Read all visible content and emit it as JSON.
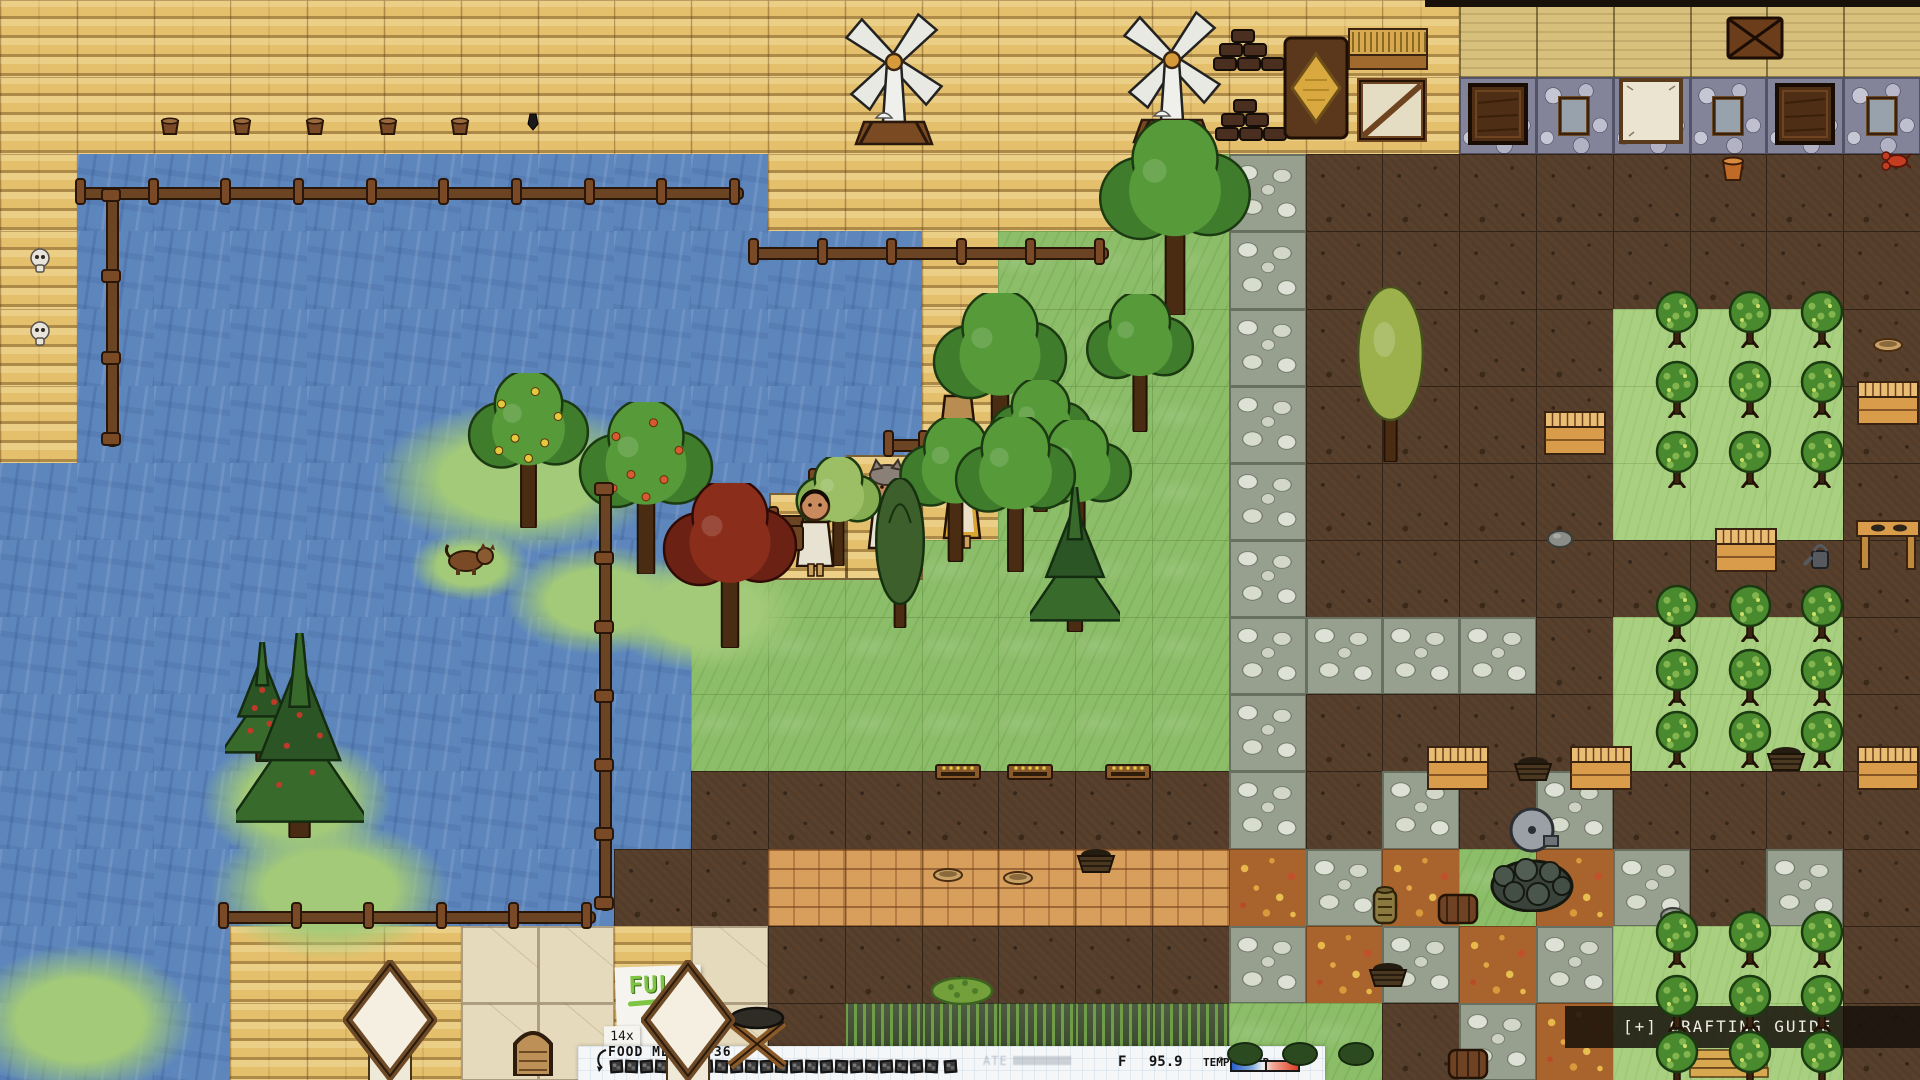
{
  "hud": {
    "crafting_guide": {
      "label": "[+] CRAFTING GUIDE"
    },
    "food_meter": {
      "label": "FOOD METER",
      "bonus": "+36",
      "multiplier": "14x",
      "boxes_total": 22,
      "boxes_filled": 22,
      "extra_boxes": 1,
      "ate_note": "ATE"
    },
    "full_sign": {
      "label": "FULL",
      "icon": "cookie-icon"
    },
    "temp_meter": {
      "unit": "F",
      "value": "95.9",
      "label": "TEMP METER",
      "indicator_pos": 0.44
    }
  },
  "colors": {
    "water": "#5d86bd",
    "plank": "#e5c06c",
    "grass": "#8cbd68",
    "grass_light": "#a9d080",
    "dirt": "#58402d",
    "cobble": "#97a08e",
    "brick": "#d79e5c",
    "leaf": "#a8642c",
    "full_green": "#7ec544",
    "temp_cold": "#2b5fc9",
    "temp_hot": "#dd3d22",
    "craft_bar": "rgba(22,16,10,0.85)",
    "hud_paper": "#f4f6f8"
  },
  "scene": {
    "tile_w": 76.8,
    "tile_h": 77.142,
    "tiles": [
      "PPPPPPPPPPPPPPPPPPPTTTTTT",
      "PPPPPPPPPPPPPPPPPPPSSSSSS",
      "PWWWWWWWWWPPPPPGCDDDDDDDD",
      "PWWWWWWWWWWWPGGGCDDDDDDDD",
      "PWWWWWWWWWWWPGGGCDDDDHHHD",
      "PWWWWWWWWWWWPGGGCDDDDHHHD",
      "WWWWWWWWWWWWPGGGCDDDDHHHD",
      "WWWWWWWWWGGGGGGGCDDDDDDDD",
      "WWWWWWWWWGGGGGGGCCCCDHHHD",
      "WWWWWWWWWGGGGGGGCDDDDHHHD",
      "WWWWWWWWWDDDDDDDCDCDCDDDD",
      "WWWWWWWWDDBBBBBBLCLGLCDCD",
      "WWWPPPAAPADDDDDDCLCLCHHHD",
      "WWWPPPAAPADRRRRRGGDCLHHHD"
    ],
    "objects": [
      {
        "t": "blob",
        "x": 520,
        "y": 478,
        "w": 290,
        "h": 150
      },
      {
        "t": "blob",
        "x": 600,
        "y": 600,
        "w": 190,
        "h": 110
      },
      {
        "t": "blob",
        "x": 705,
        "y": 612,
        "w": 200,
        "h": 120
      },
      {
        "t": "blob",
        "x": 330,
        "y": 890,
        "w": 240,
        "h": 140
      },
      {
        "t": "blob",
        "x": 80,
        "y": 1020,
        "w": 230,
        "h": 150
      },
      {
        "t": "blob",
        "x": 297,
        "y": 800,
        "w": 190,
        "h": 130
      },
      {
        "t": "blob",
        "x": 470,
        "y": 566,
        "w": 120,
        "h": 70
      },
      {
        "t": "step",
        "x": 846,
        "y": 455,
        "w": 77,
        "h": 125
      },
      {
        "t": "step",
        "x": 769,
        "y": 493,
        "w": 78,
        "h": 87
      },
      {
        "t": "fenceH",
        "x": 75,
        "y": 178,
        "len": 665
      },
      {
        "t": "fenceH",
        "x": 748,
        "y": 238,
        "len": 357
      },
      {
        "t": "fenceH",
        "x": 218,
        "y": 902,
        "len": 374
      },
      {
        "t": "fenceV",
        "x": 97,
        "y": 188,
        "len": 255
      },
      {
        "t": "fenceV",
        "x": 590,
        "y": 482,
        "len": 425
      },
      {
        "t": "fenceH",
        "x": 733,
        "y": 506,
        "len": 80
      },
      {
        "t": "fenceH",
        "x": 808,
        "y": 468,
        "len": 80
      },
      {
        "t": "fenceH",
        "x": 883,
        "y": 430,
        "len": 80
      },
      {
        "t": "windmill",
        "x": 894,
        "y": 150
      },
      {
        "t": "windmill",
        "x": 1172,
        "y": 148
      },
      {
        "t": "bricks",
        "x": 1249,
        "y": 72
      },
      {
        "t": "bricks",
        "x": 1251,
        "y": 142
      },
      {
        "t": "kiln",
        "x": 1316,
        "y": 142
      },
      {
        "t": "wheatTable",
        "x": 1388,
        "y": 70
      },
      {
        "t": "crate2",
        "x": 1392,
        "y": 142
      },
      {
        "t": "chest",
        "x": 1755,
        "y": 60
      },
      {
        "t": "wallDoor",
        "x": 1498,
        "y": 145
      },
      {
        "t": "wallWindow",
        "x": 1574,
        "y": 136
      },
      {
        "t": "wallPaper",
        "x": 1651,
        "y": 144
      },
      {
        "t": "wallWindow",
        "x": 1728,
        "y": 136
      },
      {
        "t": "wallDoor",
        "x": 1805,
        "y": 145
      },
      {
        "t": "wallWindow",
        "x": 1882,
        "y": 136
      },
      {
        "t": "bucket",
        "x": 170,
        "y": 136
      },
      {
        "t": "bucket",
        "x": 242,
        "y": 136
      },
      {
        "t": "bucket",
        "x": 315,
        "y": 136
      },
      {
        "t": "bucket",
        "x": 388,
        "y": 136
      },
      {
        "t": "bucket",
        "x": 460,
        "y": 136
      },
      {
        "t": "chisel",
        "x": 533,
        "y": 132
      },
      {
        "t": "skull",
        "x": 40,
        "y": 274
      },
      {
        "t": "skull",
        "x": 40,
        "y": 347
      },
      {
        "t": "lobster",
        "x": 1896,
        "y": 172
      },
      {
        "t": "pot",
        "x": 1733,
        "y": 182
      },
      {
        "t": "tree",
        "x": 1175,
        "y": 315,
        "s": 170
      },
      {
        "t": "tree",
        "x": 1140,
        "y": 432,
        "s": 120
      },
      {
        "t": "tree",
        "x": 1000,
        "y": 465,
        "s": 150
      },
      {
        "t": "tree",
        "x": 1040,
        "y": 512,
        "s": 115
      },
      {
        "t": "tree",
        "x": 955,
        "y": 562,
        "s": 125
      },
      {
        "t": "tree",
        "x": 1015,
        "y": 572,
        "s": 135
      },
      {
        "t": "tree",
        "x": 1078,
        "y": 558,
        "s": 120
      },
      {
        "t": "pine",
        "x": 1075,
        "y": 632,
        "s": 145
      },
      {
        "t": "cypress",
        "x": 900,
        "y": 628,
        "s": 150
      },
      {
        "t": "maroon",
        "x": 730,
        "y": 648,
        "s": 150
      },
      {
        "t": "tree",
        "x": 838,
        "y": 566,
        "s": 95,
        "v": "light"
      },
      {
        "t": "poplar",
        "x": 1390,
        "y": 462,
        "s": 175
      },
      {
        "t": "fruit",
        "x": 528,
        "y": 528,
        "s": 135,
        "dots": "#e6c83e"
      },
      {
        "t": "fruit",
        "x": 646,
        "y": 574,
        "s": 150,
        "dots": "#d85a32"
      },
      {
        "t": "pine",
        "x": 262,
        "y": 762,
        "s": 120,
        "dots": "#c03a2a"
      },
      {
        "t": "pine",
        "x": 300,
        "y": 838,
        "s": 205,
        "dots": "#c03a2a"
      },
      {
        "t": "bush",
        "x": 1677,
        "y": 348
      },
      {
        "t": "bush",
        "x": 1750,
        "y": 348
      },
      {
        "t": "bush",
        "x": 1822,
        "y": 348
      },
      {
        "t": "bush",
        "x": 1677,
        "y": 418
      },
      {
        "t": "bush",
        "x": 1750,
        "y": 418
      },
      {
        "t": "bush",
        "x": 1822,
        "y": 418
      },
      {
        "t": "bush",
        "x": 1677,
        "y": 488
      },
      {
        "t": "bush",
        "x": 1750,
        "y": 488
      },
      {
        "t": "bush",
        "x": 1822,
        "y": 488
      },
      {
        "t": "bush",
        "x": 1677,
        "y": 642
      },
      {
        "t": "bush",
        "x": 1750,
        "y": 642
      },
      {
        "t": "bush",
        "x": 1822,
        "y": 642
      },
      {
        "t": "bush",
        "x": 1677,
        "y": 706
      },
      {
        "t": "bush",
        "x": 1750,
        "y": 706
      },
      {
        "t": "bush",
        "x": 1822,
        "y": 706
      },
      {
        "t": "bush",
        "x": 1677,
        "y": 768
      },
      {
        "t": "bush",
        "x": 1750,
        "y": 768
      },
      {
        "t": "bush",
        "x": 1822,
        "y": 768
      },
      {
        "t": "bush",
        "x": 1677,
        "y": 968
      },
      {
        "t": "bush",
        "x": 1750,
        "y": 968
      },
      {
        "t": "bush",
        "x": 1822,
        "y": 968
      },
      {
        "t": "bush",
        "x": 1677,
        "y": 1032
      },
      {
        "t": "bush",
        "x": 1750,
        "y": 1032
      },
      {
        "t": "bush",
        "x": 1822,
        "y": 1032
      },
      {
        "t": "bush",
        "x": 1677,
        "y": 1088
      },
      {
        "t": "bush",
        "x": 1750,
        "y": 1088
      },
      {
        "t": "bush",
        "x": 1822,
        "y": 1088
      },
      {
        "t": "shrub",
        "x": 1245,
        "y": 1066
      },
      {
        "t": "shrub",
        "x": 1300,
        "y": 1066
      },
      {
        "t": "shrub",
        "x": 1356,
        "y": 1066
      },
      {
        "t": "sign",
        "x": 958,
        "y": 782
      },
      {
        "t": "sign",
        "x": 1030,
        "y": 782
      },
      {
        "t": "sign",
        "x": 1128,
        "y": 782
      },
      {
        "t": "person",
        "x": 815,
        "y": 578,
        "hat": "hair",
        "cloth": "#e8e2d2",
        "pack": true
      },
      {
        "t": "person",
        "x": 887,
        "y": 560,
        "hat": "wolf",
        "cloth": "#e8e2d2"
      },
      {
        "t": "person",
        "x": 962,
        "y": 550,
        "hat": "bonnet",
        "cloth": "#d9a430"
      },
      {
        "t": "person",
        "x": 958,
        "y": 452,
        "hat": "straw",
        "cloth": "#b98c52"
      },
      {
        "t": "dog",
        "x": 470,
        "y": 575
      },
      {
        "t": "bowl",
        "x": 1888,
        "y": 352
      },
      {
        "t": "crate",
        "x": 1888,
        "y": 425
      },
      {
        "t": "crate",
        "x": 1575,
        "y": 455
      },
      {
        "t": "crate",
        "x": 1746,
        "y": 572
      },
      {
        "t": "wateringCan",
        "x": 1818,
        "y": 570
      },
      {
        "t": "table",
        "x": 1888,
        "y": 570
      },
      {
        "t": "stone",
        "x": 1560,
        "y": 548
      },
      {
        "t": "crate",
        "x": 1458,
        "y": 790
      },
      {
        "t": "crate",
        "x": 1601,
        "y": 790
      },
      {
        "t": "crate",
        "x": 1888,
        "y": 790
      },
      {
        "t": "basket",
        "x": 1533,
        "y": 782
      },
      {
        "t": "basket",
        "x": 1786,
        "y": 772
      },
      {
        "t": "well",
        "x": 1532,
        "y": 912
      },
      {
        "t": "jug",
        "x": 1385,
        "y": 925
      },
      {
        "t": "barrel",
        "x": 1458,
        "y": 925
      },
      {
        "t": "stone",
        "x": 1673,
        "y": 925
      },
      {
        "t": "basket",
        "x": 1388,
        "y": 988
      },
      {
        "t": "barrel",
        "x": 1468,
        "y": 1080
      },
      {
        "t": "plankStack",
        "x": 1728,
        "y": 1080
      },
      {
        "t": "trough",
        "x": 757,
        "y": 1072
      },
      {
        "t": "bowl",
        "x": 948,
        "y": 882
      },
      {
        "t": "bowl",
        "x": 1018,
        "y": 885
      },
      {
        "t": "basket",
        "x": 1096,
        "y": 874
      },
      {
        "t": "mound",
        "x": 962,
        "y": 1005
      },
      {
        "t": "tent",
        "x": 390,
        "y": 1084
      },
      {
        "t": "tent",
        "x": 688,
        "y": 1084
      },
      {
        "t": "arch",
        "x": 533,
        "y": 1076
      }
    ]
  }
}
